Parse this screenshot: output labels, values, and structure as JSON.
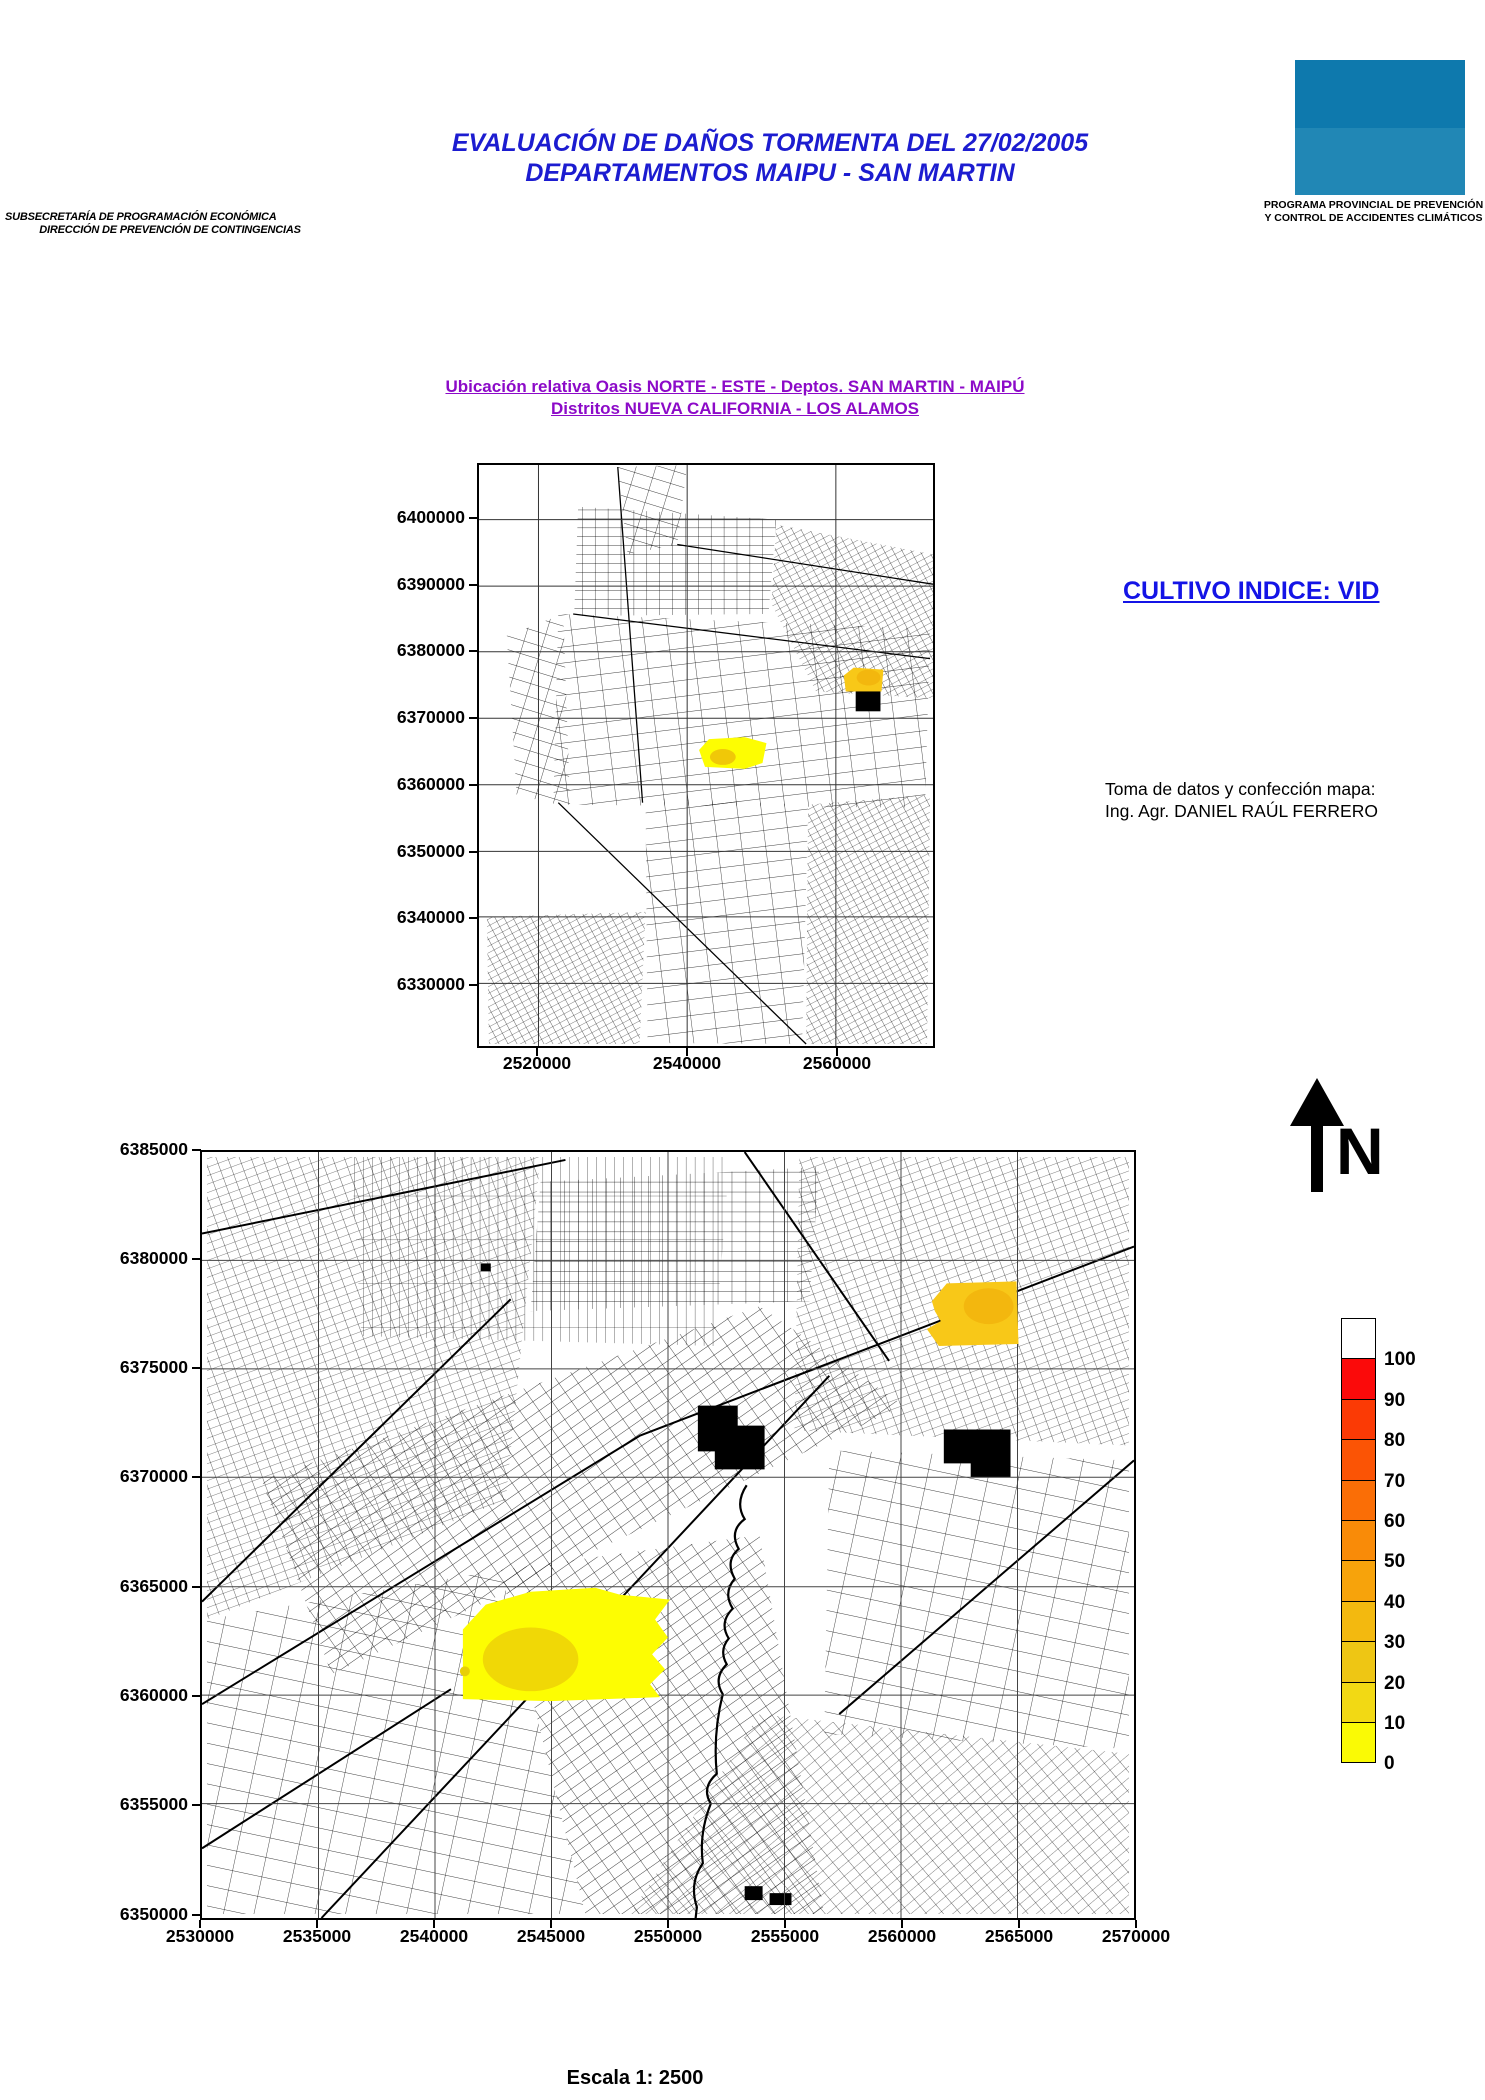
{
  "agency": {
    "line1": "SUBSECRETARÍA DE PROGRAMACIÓN ECONÓMICA",
    "line2": "DIRECCIÓN DE PREVENCIÓN DE CONTINGENCIAS"
  },
  "title": {
    "line1": "EVALUACIÓN DE DAÑOS TORMENTA DEL 27/02/2005",
    "line2": "DEPARTAMENTOS MAIPU - SAN MARTIN",
    "color": "#1c1cd0"
  },
  "program": {
    "line1": "PROGRAMA PROVINCIAL DE PREVENCIÓN",
    "line2": "Y CONTROL DE ACCIDENTES CLIMÁTICOS",
    "logo_color_top": "#0e79ad",
    "logo_color_bottom": "#2187b5"
  },
  "subtitle": {
    "line1": "Ubicación relativa Oasis NORTE - ESTE - Deptos. SAN MARTIN - MAIPÚ",
    "line2": "Distritos NUEVA CALIFORNIA - LOS ALAMOS",
    "color": "#8c0ac8"
  },
  "crop_index_label": "CULTIVO INDICE: VID",
  "crop_index_color": "#1414e6",
  "credit": {
    "line1": "Toma de datos y confección mapa:",
    "line2": "Ing. Agr. DANIEL RAÚL FERRERO"
  },
  "north_label": "N",
  "scale_label": "Escala 1: 2500",
  "overview_map": {
    "y_ticks": [
      "6400000",
      "6390000",
      "6380000",
      "6370000",
      "6360000",
      "6350000",
      "6340000",
      "6330000"
    ],
    "x_ticks": [
      "2520000",
      "2540000",
      "2560000"
    ]
  },
  "detail_map": {
    "y_ticks": [
      "6385000",
      "6380000",
      "6375000",
      "6370000",
      "6365000",
      "6360000",
      "6355000",
      "6350000"
    ],
    "x_ticks": [
      "2530000",
      "2535000",
      "2540000",
      "2545000",
      "2550000",
      "2555000",
      "2560000",
      "2565000",
      "2570000"
    ]
  },
  "legend": {
    "labels": [
      "100",
      "90",
      "80",
      "70",
      "60",
      "50",
      "40",
      "30",
      "20",
      "10",
      "0"
    ],
    "colors_top_to_bottom": [
      "#ffffff",
      "#fb0a0a",
      "#fb3a05",
      "#fb5405",
      "#fa6e06",
      "#f98b08",
      "#f7a30b",
      "#f3b90f",
      "#eec614",
      "#f2d914",
      "#fafa05"
    ],
    "damage_patch_bright_yellow": "#fdfd02",
    "damage_patch_gold": "#f8c818"
  }
}
